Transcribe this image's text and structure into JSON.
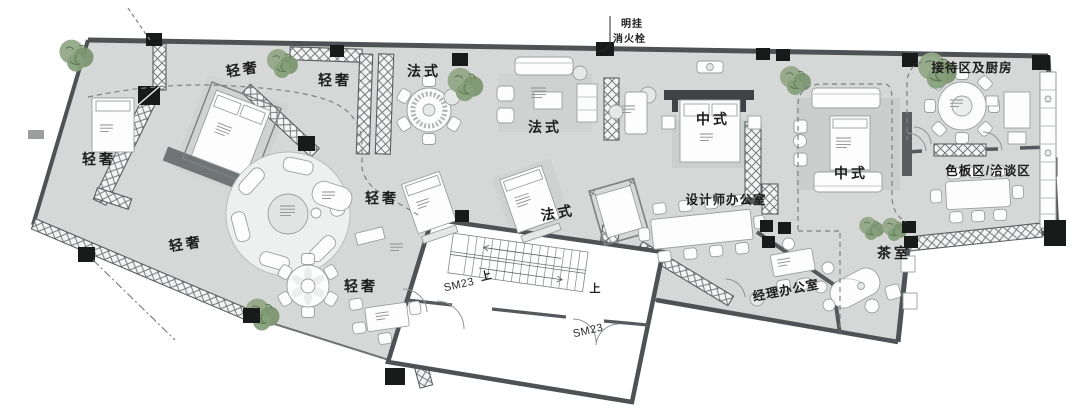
{
  "palette": {
    "floor": "#d6d8d7",
    "rug": "#c8cbca",
    "rug_light": "#edefee",
    "wall": "#4e5254",
    "column": "#191b1b",
    "furniture_outline": "#9aa09f",
    "tree_green": "#7f9878",
    "dashed_path": "#7d8183",
    "paper": "#ffffff"
  },
  "callout": {
    "line1": "明挂",
    "line2": "消火栓"
  },
  "zones": {
    "qingshe_top_a": "轻奢",
    "qingshe_top_b": "轻奢",
    "fashi_dining": "法式",
    "fashi_living": "法式",
    "zhongshi_a": "中式",
    "reception_kitchen": "接待区及厨房",
    "qingshe_left": "轻奢",
    "qingshe_mid": "轻奢",
    "fashi_bed": "法式",
    "zhongshi_b": "中式",
    "seban_qiatan": "色板区/洽谈区",
    "designer_office": "设计师办公室",
    "qingshe_circle": "轻奢",
    "tea_room": "茶室",
    "qingshe_bottom": "轻奢",
    "manager_office": "经理办公室"
  },
  "stairs": {
    "door_a": "SM23",
    "door_b": "SM23",
    "up_a": "上",
    "up_b": "上"
  }
}
